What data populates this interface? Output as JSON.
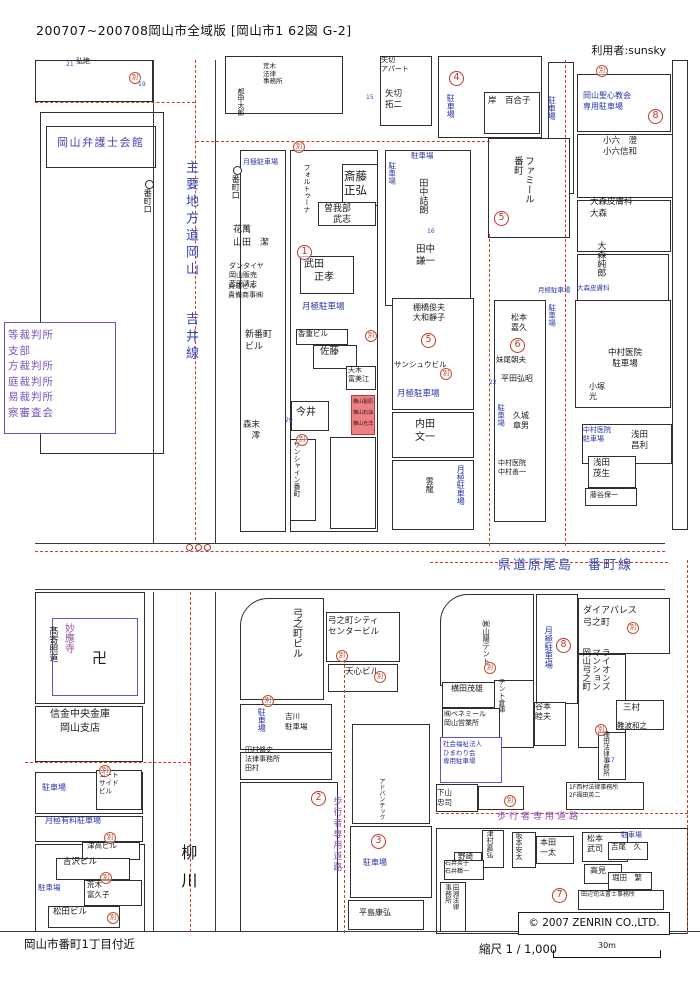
{
  "header": {
    "title": "200707~200708岡山市全域版 [岡山市1 62図 G-2]",
    "user": "利用者:sunsky"
  },
  "footer": {
    "area": "岡山市番町1丁目付近",
    "scale_label": "縮尺 1 / 1,000",
    "scale_distance": "30m"
  },
  "map": {
    "copyright": "© 2007 ZENRIN CO.,LTD.",
    "betsu": "別",
    "accent_colors": {
      "boundary_red": "#cf3a30",
      "parking_blue": "#2a35a8",
      "street_blue": "#3a47b0",
      "public_purple": "#7b52bb",
      "highlight_pink": "#ec8084"
    },
    "labels": [
      {
        "t": "弘絶",
        "c": "k"
      },
      {
        "t": "21",
        "c": "num"
      },
      {
        "t": "19",
        "c": "num"
      },
      {
        "t": "岡山弁護士会館",
        "c": "pub"
      },
      {
        "t": "等裁判所\n支部\n方裁判所\n庭裁判所\n易裁判所\n察審査会",
        "c": "crt"
      },
      {
        "t": "主要地方道岡山",
        "c": "stv"
      },
      {
        "t": "吉井線",
        "c": "stv"
      },
      {
        "t": "番町口",
        "c": "bus"
      },
      {
        "t": "番町口",
        "c": "bus"
      },
      {
        "t": "月極駐車場",
        "c": "b"
      },
      {
        "t": "荒木\n法律\n事務所",
        "c": "k"
      },
      {
        "t": "15",
        "c": "num"
      },
      {
        "t": "花萬\n山田　潔",
        "c": "k"
      },
      {
        "t": "ダンタイヤ\n岡山販売\n苫田清志",
        "c": "k"
      },
      {
        "t": "貴運ビル\n貴備商事㈱",
        "c": "k"
      },
      {
        "t": "フォルトゥーナ",
        "c": "kv"
      },
      {
        "t": "斎藤\n正弘",
        "c": "k"
      },
      {
        "t": "曽我部\n　武志",
        "c": "k"
      },
      {
        "t": "1",
        "c": "circ"
      },
      {
        "t": "武田\n　正孝",
        "c": "k"
      },
      {
        "t": "月極駐車場",
        "c": "b"
      },
      {
        "t": "香重ビル",
        "c": "k"
      },
      {
        "t": "佐藤",
        "c": "k"
      },
      {
        "t": "天木\n富美江",
        "c": "k"
      },
      {
        "t": "今井",
        "c": "k"
      },
      {
        "t": "新番町\nビル",
        "c": "k"
      },
      {
        "t": "森末\n　澪",
        "c": "k"
      },
      {
        "t": "サンシャイン番町",
        "c": "kv"
      },
      {
        "t": "29",
        "c": "num"
      },
      {
        "t": "矢切\nアパート",
        "c": "k"
      },
      {
        "t": "矢切\n拓二",
        "c": "k"
      },
      {
        "t": "4",
        "c": "circ"
      },
      {
        "t": "駐車場",
        "c": "bv"
      },
      {
        "t": "岸　百合子",
        "c": "k"
      },
      {
        "t": "駐車場",
        "c": "b"
      },
      {
        "t": "駐車場",
        "c": "bv"
      },
      {
        "t": "田中詰朗",
        "c": "kv"
      },
      {
        "t": "田中\n謙一",
        "c": "k"
      },
      {
        "t": "16",
        "c": "num"
      },
      {
        "t": "ファミール\n番町",
        "c": "kv"
      },
      {
        "t": "5",
        "c": "circ"
      },
      {
        "t": "月極駐車場",
        "c": "b"
      },
      {
        "t": "大森皮膚科",
        "c": "b"
      },
      {
        "t": "岡山聖心教会\n専用駐車場",
        "c": "b"
      },
      {
        "t": "8",
        "c": "circ"
      },
      {
        "t": "駐車場",
        "c": "bv"
      },
      {
        "t": "小六　澄\n小六信和",
        "c": "k"
      },
      {
        "t": "大森皮膚科\n大森",
        "c": "k"
      },
      {
        "t": "大森純郎",
        "c": "kv"
      },
      {
        "t": "棚橋俊夫\n大和靜子",
        "c": "k"
      },
      {
        "t": "5",
        "c": "circ"
      },
      {
        "t": "サンシュウビル",
        "c": "k"
      },
      {
        "t": "月極駐車場",
        "c": "b"
      },
      {
        "t": "内田\n文一",
        "c": "k"
      },
      {
        "t": "雲龍",
        "c": "kv"
      },
      {
        "t": "月極駐車場",
        "c": "bv"
      },
      {
        "t": "松本\n嘉久",
        "c": "k"
      },
      {
        "t": "6",
        "c": "circ"
      },
      {
        "t": "妹尾朝夫",
        "c": "k"
      },
      {
        "t": "平田弘昭",
        "c": "k"
      },
      {
        "t": "駐車場",
        "c": "bv"
      },
      {
        "t": "久城\n章男",
        "c": "k"
      },
      {
        "t": "中村医院\n中村善一",
        "c": "k"
      },
      {
        "t": "駐車場",
        "c": "bv"
      },
      {
        "t": "中村医院\n駐車場",
        "c": "kc"
      },
      {
        "t": "小塚\n光",
        "c": "k"
      },
      {
        "t": "中村医院\n駐車場",
        "c": "b"
      },
      {
        "t": "浅田\n昌利",
        "c": "k"
      },
      {
        "t": "浅田\n茂生",
        "c": "k"
      },
      {
        "t": "藤谷保一",
        "c": "k"
      },
      {
        "t": "県道原尾島　番町線",
        "c": "sth"
      },
      {
        "t": "妙應寺",
        "c": "pv"
      },
      {
        "t": "髙寄照道",
        "c": "kv"
      },
      {
        "t": "卍",
        "c": "manji"
      },
      {
        "t": "信金中央金庫\n岡山支店",
        "c": "kc"
      },
      {
        "t": "駐車場",
        "c": "b"
      },
      {
        "t": "コート\nサイド\nビル",
        "c": "k"
      },
      {
        "t": "月極有料駐車場",
        "c": "b"
      },
      {
        "t": "津高ビル",
        "c": "k"
      },
      {
        "t": "吉沢ビル",
        "c": "k"
      },
      {
        "t": "駐車場",
        "c": "b"
      },
      {
        "t": "荒木\n富久子",
        "c": "k"
      },
      {
        "t": "松田ビル",
        "c": "k"
      },
      {
        "t": "柳川",
        "c": "rv"
      },
      {
        "t": "弓之町ビル",
        "c": "kv"
      },
      {
        "t": "弓之町シティ\nセンタービル",
        "c": "k"
      },
      {
        "t": "天心ビル",
        "c": "k"
      },
      {
        "t": "駐車場",
        "c": "bv"
      },
      {
        "t": "吉川\n駐車場",
        "c": "k"
      },
      {
        "t": "田村脩史\n法律事務所\n田村",
        "c": "k"
      },
      {
        "t": "2",
        "c": "circ"
      },
      {
        "t": "歩行者専用道路",
        "c": "pedv"
      },
      {
        "t": "3",
        "c": "circ"
      },
      {
        "t": "駐車場",
        "c": "b"
      },
      {
        "t": "平島康弘",
        "c": "k"
      },
      {
        "t": "アドバンテック",
        "c": "kv"
      },
      {
        "t": "㈱山陽テント",
        "c": "kv"
      },
      {
        "t": "横田茂雄",
        "c": "k"
      },
      {
        "t": "テント倉庫",
        "c": "kv"
      },
      {
        "t": "㈱ベネミール\n岡山営業所",
        "c": "k"
      },
      {
        "t": "社会福祉法人\nひまわり会\n専用駐車場",
        "c": "b"
      },
      {
        "t": "月極駐車場",
        "c": "bv"
      },
      {
        "t": "8",
        "c": "circ"
      },
      {
        "t": "ダイアパレス\n弓之町",
        "c": "k"
      },
      {
        "t": "ライオンズ\nマンション\n岡山弓之町",
        "c": "kv"
      },
      {
        "t": "谷本\n睦夫",
        "c": "k"
      },
      {
        "t": "三村",
        "c": "k"
      },
      {
        "t": "難波和之",
        "c": "k"
      },
      {
        "t": "種田法律事務所",
        "c": "kv"
      },
      {
        "t": "下山\n忠司",
        "c": "k"
      },
      {
        "t": "1F西村法律事務所\n2F福田英二",
        "c": "k"
      },
      {
        "t": "歩行者専用道路",
        "c": "pedh"
      },
      {
        "t": "津村嘉弘",
        "c": "kv"
      },
      {
        "t": "野崎",
        "c": "k"
      },
      {
        "t": "石井英子\n石井鶴一",
        "c": "k"
      },
      {
        "t": "坂本安太",
        "c": "kv"
      },
      {
        "t": "本田\n一太",
        "c": "k"
      },
      {
        "t": "松本\n武司",
        "c": "k"
      },
      {
        "t": "吉尾　久",
        "c": "k"
      },
      {
        "t": "駐車場",
        "c": "b"
      },
      {
        "t": "高見",
        "c": "k"
      },
      {
        "t": "堀田　繁",
        "c": "k"
      },
      {
        "t": "田淵法律\n事務所",
        "c": "kv"
      },
      {
        "t": "7",
        "c": "circ"
      },
      {
        "t": "田辺司法書士事務所",
        "c": "k"
      },
      {
        "t": "17",
        "c": "num"
      },
      {
        "t": "22",
        "c": "num"
      },
      {
        "t": "都甲太郎",
        "c": "kv"
      },
      {
        "t": "横山製原\n横山石油\n横山光洋",
        "c": "hl"
      }
    ]
  }
}
